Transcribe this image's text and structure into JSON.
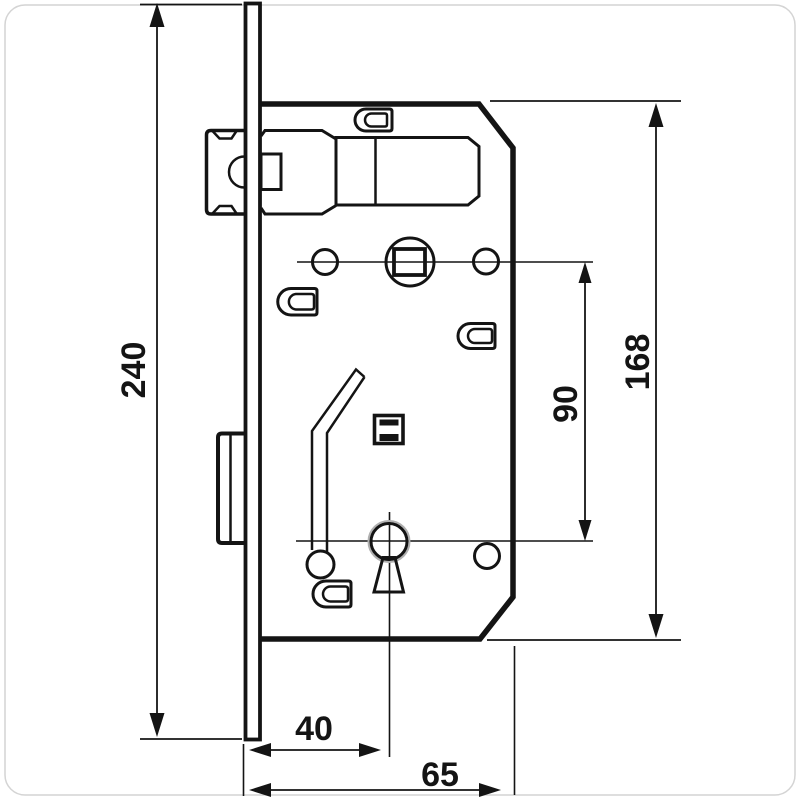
{
  "drawing": {
    "type": "technical-dimension-drawing",
    "subject": "mortise-door-lock-side-view",
    "background_color": "#ffffff",
    "line_color": "#141414",
    "dimensions": [
      {
        "id": "overall-faceplate-height",
        "label": "240",
        "orientation": "vertical",
        "side": "left"
      },
      {
        "id": "case-height",
        "label": "168",
        "orientation": "vertical",
        "side": "right"
      },
      {
        "id": "spindle-to-key-centres",
        "label": "90",
        "orientation": "vertical",
        "side": "right-inner"
      },
      {
        "id": "backset",
        "label": "40",
        "orientation": "horizontal",
        "side": "bottom"
      },
      {
        "id": "case-depth",
        "label": "65",
        "orientation": "horizontal",
        "side": "bottom"
      }
    ],
    "parts": [
      "faceplate",
      "lock-case",
      "latch-bolt",
      "deadbolt",
      "spindle-hole-with-square",
      "fixing-hole-left",
      "fixing-hole-right",
      "bottom-fixing-hole",
      "keyhole",
      "lever-spring",
      "spring-box",
      "screw-post-top",
      "screw-post-left",
      "screw-post-right",
      "screw-post-bottom"
    ]
  }
}
